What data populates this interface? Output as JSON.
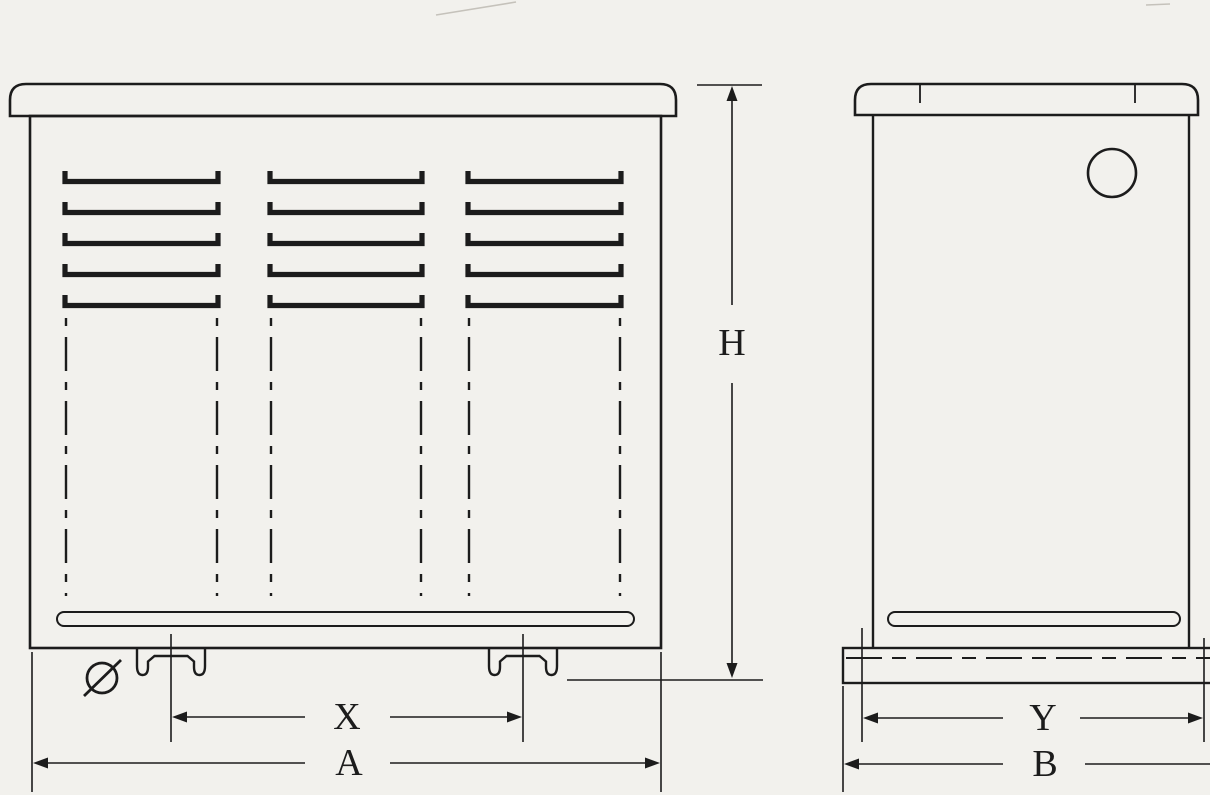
{
  "drawing": {
    "colors": {
      "paper": "#f2f1ed",
      "ink": "#1c1c1c"
    },
    "front_view": {
      "dim_height_label": "H",
      "dim_foot_spacing_label": "X",
      "dim_overall_width_label": "A",
      "diameter_symbol": "Ø",
      "louver_columns": 3,
      "louvers_per_column": 5,
      "feet_count": 2
    },
    "side_view": {
      "dim_base_span_label": "Y",
      "dim_overall_depth_label": "B",
      "hole_count": 1,
      "cap_tick_count": 2
    }
  }
}
